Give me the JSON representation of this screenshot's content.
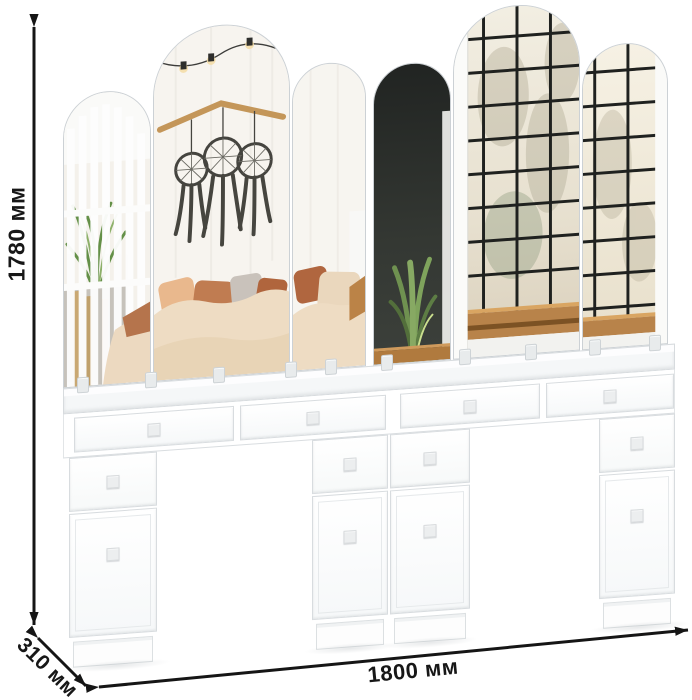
{
  "page": {
    "background": "#ffffff"
  },
  "dimensions": {
    "height": {
      "label": "1780 мм",
      "value_mm": 1780,
      "orientation": "vertical-left"
    },
    "depth": {
      "label": "310 мм",
      "value_mm": 310,
      "orientation": "diagonal-bottom-left"
    },
    "width": {
      "label": "1800 мм",
      "value_mm": 1800,
      "orientation": "horizontal-bottom"
    }
  },
  "annotation": {
    "arrow_color": "#151515",
    "label_color": "#171717",
    "arrow_style": "double-headed"
  },
  "product": {
    "description": "white double dressing table with four pedestals, four apron drawers and six arched mirror panels",
    "body_color": "#ffffff",
    "edge_color": "#d8dcdf",
    "knob_color": "#eceeef",
    "counts": {
      "mirror_panels": 6,
      "apron_drawers": 4,
      "pedestal_drawers": 4,
      "doors": 4,
      "pedestals": 4
    },
    "reflection": {
      "left_mirrors": "bedroom: white slatted screen with green plant, white brick wall, branch with three dark dreamcatchers, string lights, bed with beige duvet and terracotta, peach and grey pillows",
      "right_mirrors": "dark wall with sansevieria in wicker basket, black grid window with pale winter trees, wooden window bench"
    },
    "scene_colors": {
      "duvet": "#eedcc3",
      "pillow_terracotta": "#c07c51",
      "pillow_peach": "#e9b88d",
      "pillow_grey": "#c9c2bb",
      "dark_wall": "#30332f",
      "window_mullion": "#1f211f",
      "window_glass": "#f0ebdd",
      "wood_sill": "#b8834a",
      "plant_green": "#6f9150",
      "basket": "#d3a258",
      "branch": "#c49659",
      "dreamcatcher": "#45443f"
    }
  }
}
